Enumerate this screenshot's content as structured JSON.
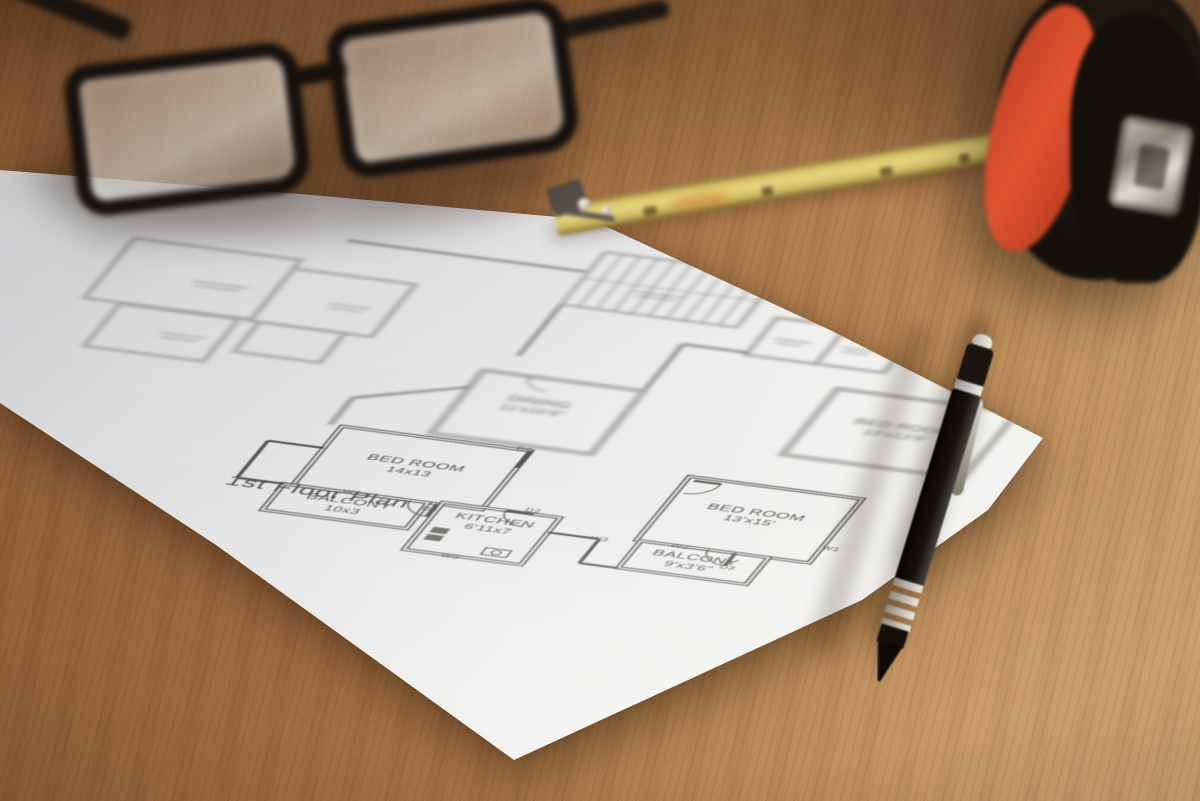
{
  "floor_plan": {
    "title": {
      "text": "1st Floor Plan",
      "x": 40,
      "y": 318
    },
    "rooms": [
      {
        "label": "BED ROOM",
        "dims": "14x13",
        "x": 215,
        "y": 224,
        "rect": [
          110,
          160,
          210,
          140
        ],
        "zone": "near"
      },
      {
        "label": "BALCONY",
        "dims": "10x3",
        "x": 180,
        "y": 325,
        "rect": [
          100,
          300,
          160,
          62
        ],
        "zone": "near"
      },
      {
        "label": "KITCHEN",
        "dims": "6'11x7",
        "x": 342,
        "y": 325,
        "rect": [
          275,
          295,
          130,
          112
        ],
        "zone": "near"
      },
      {
        "label": "BED ROOM",
        "dims": "13'x15'",
        "x": 597,
        "y": 234,
        "rect": [
          500,
          170,
          192,
          152
        ],
        "zone": "near"
      },
      {
        "label": "BALCONY",
        "dims": "9'x3'6\"",
        "x": 574,
        "y": 349,
        "rect": [
          505,
          322,
          142,
          64
        ],
        "zone": "near"
      },
      {
        "label": "BED ROOM",
        "dims": "13'x13'9\"",
        "x": 673,
        "y": 10,
        "rect": [
          575,
          -60,
          200,
          157
        ],
        "zone": "far"
      },
      {
        "label": "DINING",
        "dims": "11'x10'6\"",
        "x": 288,
        "y": 58,
        "rect": [
          205,
          0,
          178,
          150
        ],
        "zone": "far"
      }
    ],
    "markers": [
      {
        "t": "W2",
        "x": 175,
        "y": 303
      },
      {
        "t": "D3",
        "x": 267,
        "y": 317
      },
      {
        "t": "D2",
        "x": 312,
        "y": 162
      },
      {
        "t": "D2",
        "x": 372,
        "y": 291
      },
      {
        "t": "W3",
        "x": 327,
        "y": 413
      },
      {
        "t": "W3",
        "x": 462,
        "y": 333
      },
      {
        "t": "W2",
        "x": 549,
        "y": 327
      },
      {
        "t": "D3",
        "x": 614,
        "y": 359
      },
      {
        "t": "W1",
        "x": 702,
        "y": 289
      }
    ],
    "geometry": {
      "walls_near": [
        [
          405,
          330,
          462,
          330
        ],
        [
          462,
          330,
          462,
          387
        ],
        [
          462,
          387,
          505,
          387
        ],
        [
          110,
          212,
          48,
          212
        ],
        [
          48,
          212,
          48,
          300
        ],
        [
          48,
          300,
          100,
          300
        ],
        [
          270,
          300,
          270,
          330
        ],
        [
          375,
          295,
          345,
          295
        ],
        [
          508,
          178,
          538,
          178
        ],
        [
          610,
          322,
          610,
          352
        ],
        [
          320,
          160,
          320,
          200
        ]
      ],
      "arcs_near": [
        "M 270 330 A 30 30 0 0 1 240 300",
        "M 345 295 A 30 30 0 0 0 375 325",
        "M 538 178 A 30 30 0 0 1 508 208",
        "M 610 352 A 30 30 0 0 1 580 322"
      ],
      "far_rects": [
        [
          455,
          -195,
          78,
          88
        ],
        [
          533,
          -195,
          75,
          88
        ],
        [
          -255,
          -185,
          185,
          142
        ],
        [
          -70,
          -165,
          135,
          125
        ],
        [
          -215,
          -40,
          132,
          100
        ],
        [
          -60,
          -40,
          95,
          70
        ]
      ],
      "walls_far": [
        [
          383,
          -5,
          383,
          -112
        ],
        [
          383,
          -112,
          455,
          -112
        ],
        [
          228,
          -163,
          228,
          -40
        ],
        [
          -40,
          -240,
          225,
          -240
        ],
        [
          97,
          160,
          97,
          96
        ],
        [
          97,
          96,
          205,
          40
        ],
        [
          423,
          -288,
          423,
          -163
        ]
      ],
      "arcs_far": [
        "M 257 0 A 28 28 0 0 0 285 28"
      ],
      "stairs": {
        "rect": [
          228,
          -288,
          195,
          125
        ],
        "treads": 9
      },
      "scribbles": [
        [
          470,
          -150,
          40
        ],
        [
          545,
          -150,
          38
        ],
        [
          -160,
          -110,
          60
        ],
        [
          -5,
          -100,
          45
        ],
        [
          -150,
          10,
          50
        ],
        [
          290,
          -212,
          55
        ]
      ],
      "fixtures": {
        "stove": [
          [
            286,
            350,
            18,
            13
          ],
          [
            286,
            367,
            18,
            13
          ]
        ],
        "sink_rect": [
          356,
          380,
          28,
          16
        ],
        "sink_circle": [
          370,
          388,
          5
        ]
      }
    }
  },
  "objects": {
    "eyeglasses": {
      "frame_color": "#16110d"
    },
    "pen": {
      "body_color": "#1b1510",
      "accent_color": "#d7d3cd"
    },
    "tape_measure": {
      "blade_color": "#d9c468",
      "body_color": "#181210",
      "stripe_color": "#d84f2c",
      "clip_color": "#b9b3aa"
    },
    "paper": {
      "color": "#e9e9ea"
    },
    "table": {
      "wood_color": "#a06c42"
    }
  },
  "theme": {
    "ink": "#4a4541",
    "paper_line": "#e9e9ea",
    "label_color": "#4b4744",
    "title_color": "#414140"
  }
}
